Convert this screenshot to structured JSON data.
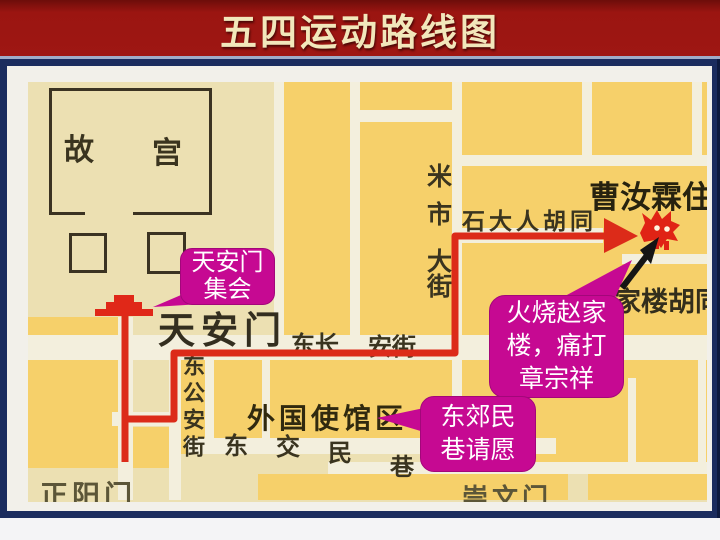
{
  "title": "五四运动路线图",
  "map": {
    "forbidden_city": "故宫",
    "tiananmen": "天安门",
    "changan_street_left": "东长",
    "changan_street_right": "安街",
    "donggongan_street": "东公安街",
    "legation_quarter": "外国使馆区",
    "dongjiaomin_lane": "东交民巷",
    "zhengyangmen": "正阳门",
    "chongwenmen": "崇文门",
    "mishi_street": "米市大街",
    "shidaren_hutong": "石大人胡同",
    "cao_rulin_residence": "曹汝霖住宅",
    "zhaojialou_hutong": "家楼胡同"
  },
  "callouts": {
    "rally": {
      "line1": "天安门",
      "line2": "集会"
    },
    "burn": {
      "line1": "火烧赵家",
      "line2": "楼，痛打",
      "line3": "章宗祥"
    },
    "petition": {
      "line1": "东郊民",
      "line2": "巷请愿"
    }
  },
  "colors": {
    "title_bg": "#9b1511",
    "title_text": "#f2e7bb",
    "frame_navy": "#1b2c5e",
    "map_bg": "#ece0b2",
    "city_block": "#f6d06a",
    "street": "#f3efdd",
    "route_red": "#dc2b19",
    "callout_magenta": "#c60992"
  }
}
